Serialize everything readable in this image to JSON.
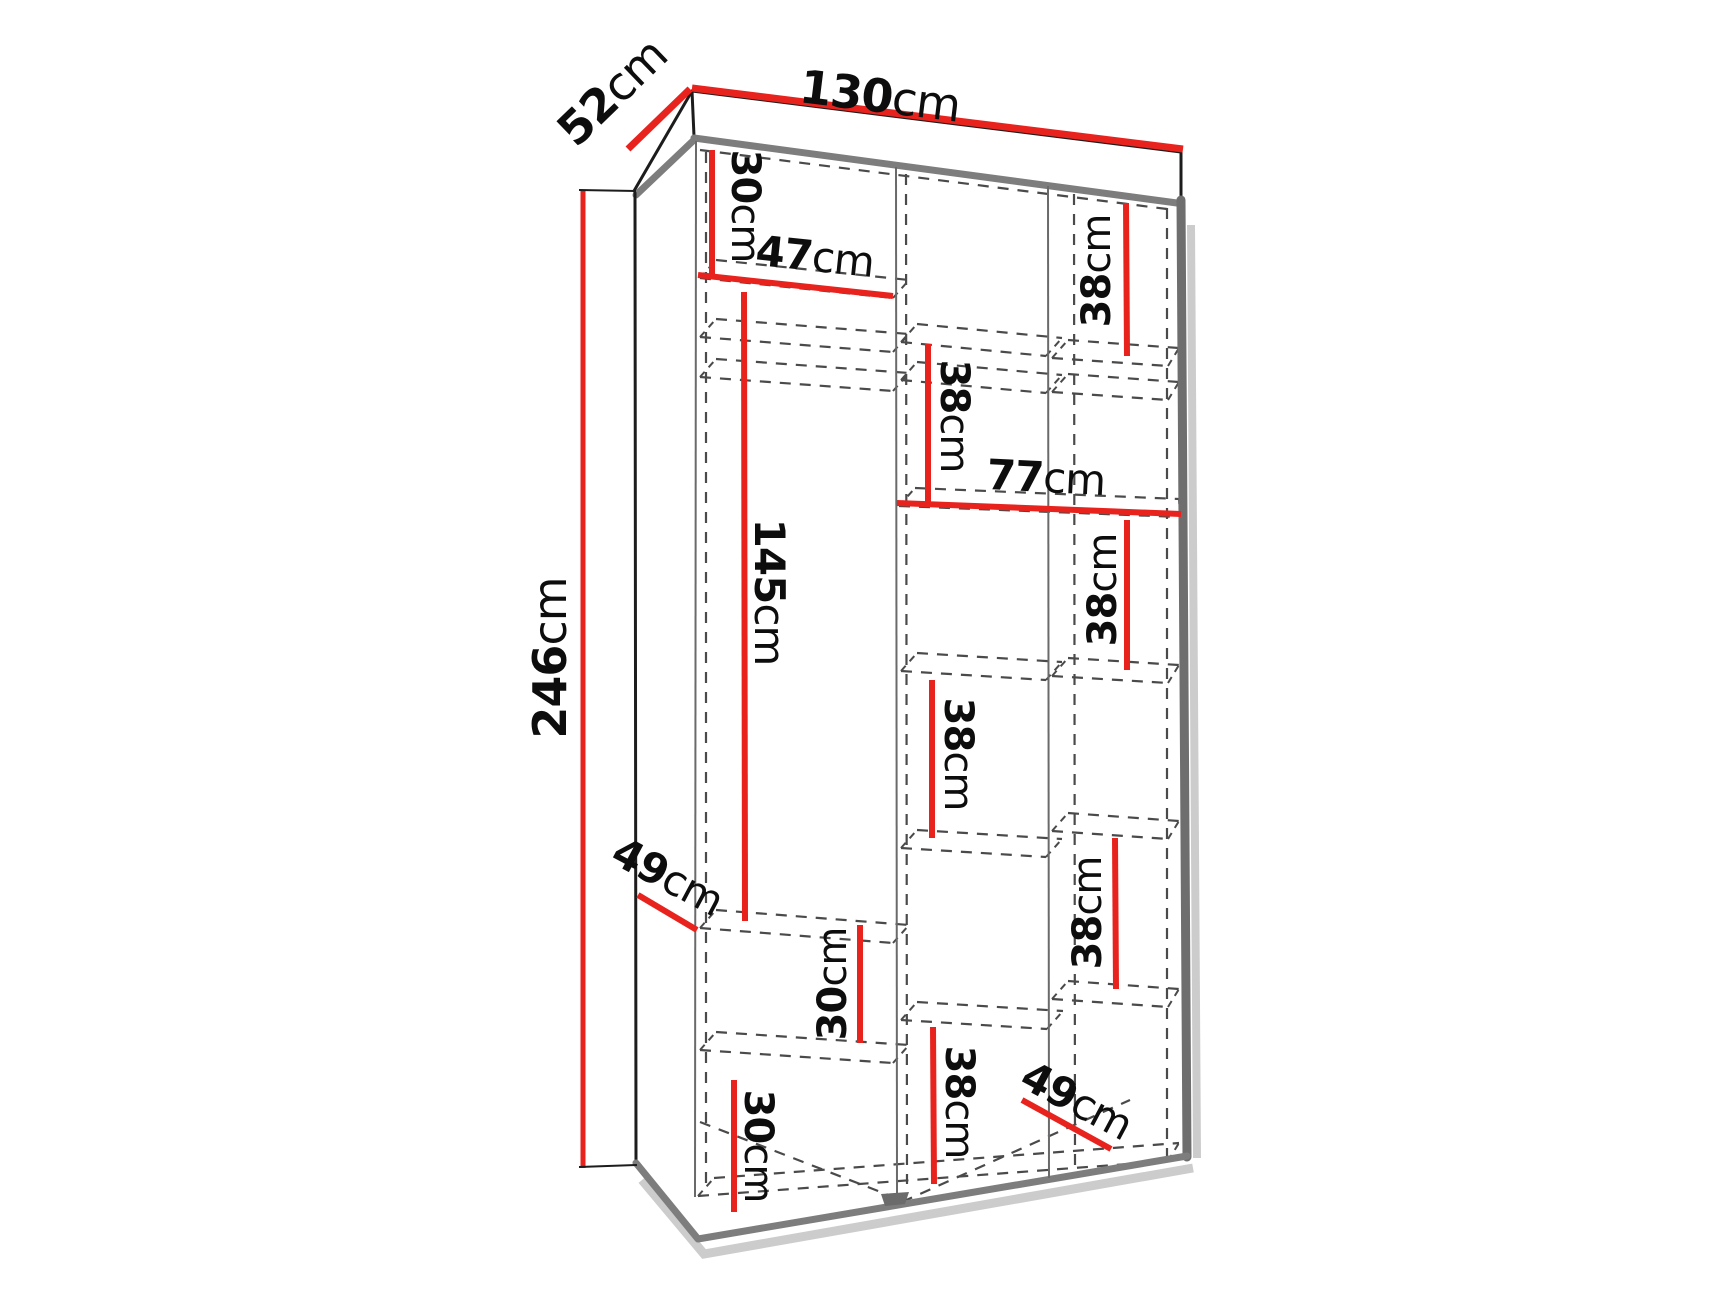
{
  "diagram": {
    "kind": "wardrobe interior dimension drawing",
    "unit": "cm",
    "sections": 3
  },
  "colors": {
    "red": "#e8231e",
    "hidden": "#4a4a4a",
    "text": "#0d0d0d",
    "gray": "#7d7d7d",
    "dark": "#6e6e6e",
    "shadow": "#cccccc",
    "bg": "#ffffff"
  },
  "labels": [
    {
      "id": "depth-52",
      "value": "52",
      "unit": "cm"
    },
    {
      "id": "width-130",
      "value": "130",
      "unit": "cm"
    },
    {
      "id": "height-246",
      "value": "246",
      "unit": "cm"
    },
    {
      "id": "top-left-30",
      "value": "30",
      "unit": "cm"
    },
    {
      "id": "shelf-47",
      "value": "47",
      "unit": "cm"
    },
    {
      "id": "top-right-38",
      "value": "38",
      "unit": "cm"
    },
    {
      "id": "mid-upper-38",
      "value": "38",
      "unit": "cm"
    },
    {
      "id": "shelf-77",
      "value": "77",
      "unit": "cm"
    },
    {
      "id": "hanging-145",
      "value": "145",
      "unit": "cm"
    },
    {
      "id": "right-upper-38",
      "value": "38",
      "unit": "cm"
    },
    {
      "id": "mid-middle-38",
      "value": "38",
      "unit": "cm"
    },
    {
      "id": "depth-left-49",
      "value": "49",
      "unit": "cm"
    },
    {
      "id": "left-lower-30",
      "value": "30",
      "unit": "cm"
    },
    {
      "id": "right-lower-38",
      "value": "38",
      "unit": "cm"
    },
    {
      "id": "bottom-left-30",
      "value": "30",
      "unit": "cm"
    },
    {
      "id": "bottom-mid-38",
      "value": "38",
      "unit": "cm"
    },
    {
      "id": "depth-right-49",
      "value": "49",
      "unit": "cm"
    }
  ]
}
